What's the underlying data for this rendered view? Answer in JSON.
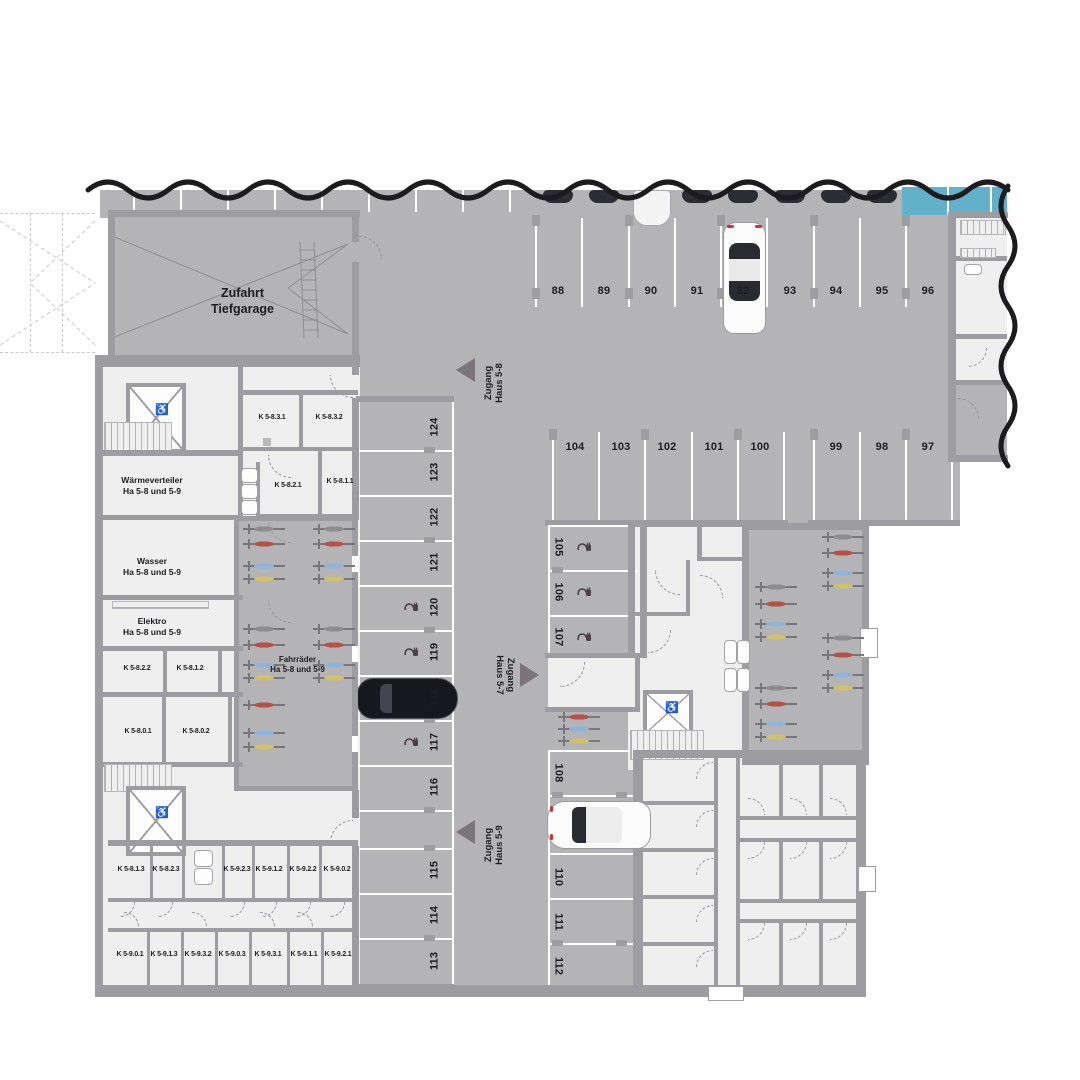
{
  "labels": {
    "zufahrt": {
      "line1": "Zufahrt",
      "line2": "Tiefgarage"
    },
    "zugang_haus_5_8": {
      "line1": "Zugang",
      "line2": "Haus 5-8"
    },
    "zugang_haus_5_7": {
      "line1": "Zugang",
      "line2": "Haus 5-7"
    },
    "zugang_haus_5_9": {
      "line1": "Zugang",
      "line2": "Haus 5-9"
    },
    "waermeverteiler": {
      "line1": "Wärmeverteiler",
      "line2": "Ha 5-8 und 5-9"
    },
    "wasser": {
      "line1": "Wasser",
      "line2": "Ha 5-8 und 5-9"
    },
    "elektro": {
      "line1": "Elektro",
      "line2": "Ha 5-8 und 5-9"
    },
    "fahrraeder": {
      "line1": "Fahrräder",
      "line2": "Ha 5-8 und 5-9"
    }
  },
  "parking": {
    "top_row": [
      "88",
      "89",
      "90",
      "91",
      "92",
      "93",
      "94",
      "95",
      "96"
    ],
    "mid_row_left": [
      "104",
      "103",
      "102",
      "101",
      "100"
    ],
    "mid_row_right": [
      "99",
      "98",
      "97"
    ],
    "left_column": [
      "124",
      "123",
      "122",
      "121",
      "120",
      "119",
      "118",
      "117",
      "116",
      "115",
      "114",
      "113"
    ],
    "mid_column_upper": [
      "105",
      "106",
      "107"
    ],
    "mid_column_lower": [
      "108",
      "110",
      "111",
      "112"
    ]
  },
  "storage_rooms": {
    "upper_block": [
      "K 5-8.3.1",
      "K 5-8.3.2",
      "K 5-8.2.1",
      "K 5-8.1.1"
    ],
    "left_block": [
      "K 5-8.2.2",
      "K 5-8.1.2",
      "K 5-8.0.1",
      "K 5-8.0.2"
    ],
    "bottom_row_upper": [
      "K 5-8.1.3",
      "K 5-8.2.3",
      "K 5-9.2.3",
      "K 5-9.1.2",
      "K 5-9.2.2",
      "K 5-9.0.2"
    ],
    "bottom_row_lower": [
      "K 5-9.0.1",
      "K 5-9.1.3",
      "K 5-9.3.2",
      "K 5-9.0.3",
      "K 5-9.3.1",
      "K 5-9.1.1",
      "K 5-9.2.1"
    ]
  },
  "icons": {
    "wheelchair": "♿"
  },
  "colors": {
    "garage_floor": "#b4b4b6",
    "room_floor": "#efeff0",
    "wall": "#9d9da1",
    "cut_line": "#1c1c1e",
    "water_blue": "#63b1c9",
    "label_text": "#1d1d1f",
    "arrow": "#7c747a"
  }
}
